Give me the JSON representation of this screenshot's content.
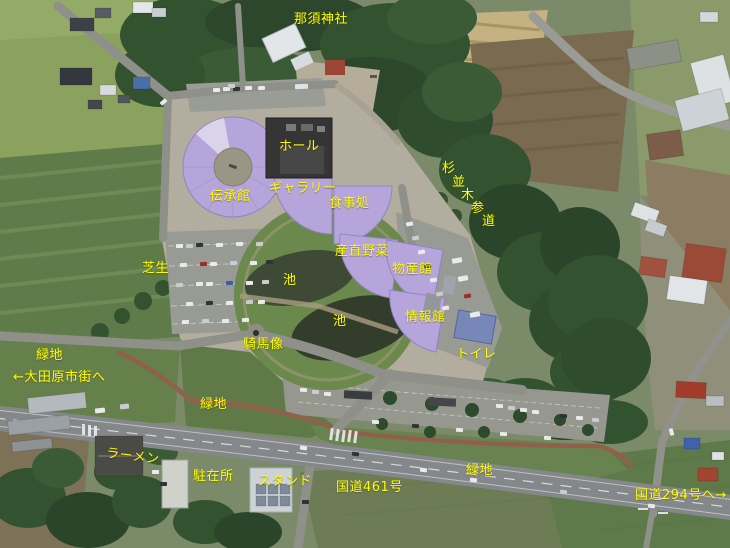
{
  "map": {
    "type": "annotated-aerial-photo",
    "colors": {
      "label_text": "#ffff00",
      "building_highlight": "#b5a5da",
      "toilet_roof": "#7787b8"
    }
  },
  "labels": [
    {
      "name": "nasu-jinja",
      "text": "那須神社",
      "x": 294,
      "y": 13
    },
    {
      "name": "hall",
      "text": "ホール",
      "x": 279,
      "y": 140
    },
    {
      "name": "denshokan",
      "text": "伝承館",
      "x": 210,
      "y": 190
    },
    {
      "name": "gallery",
      "text": "ギャラリー",
      "x": 269,
      "y": 182
    },
    {
      "name": "shokujidokoro",
      "text": "食事処",
      "x": 329,
      "y": 197
    },
    {
      "name": "suginamiki-sando",
      "chars": [
        {
          "c": "杉",
          "x": 442,
          "y": 162
        },
        {
          "c": "並",
          "x": 452,
          "y": 176
        },
        {
          "c": "木",
          "x": 461,
          "y": 189
        },
        {
          "c": "参",
          "x": 471,
          "y": 202
        },
        {
          "c": "道",
          "x": 482,
          "y": 215
        }
      ]
    },
    {
      "name": "shibafu",
      "text": "芝生",
      "x": 142,
      "y": 262
    },
    {
      "name": "sanchoku-yasai",
      "text": "産直野菜",
      "x": 335,
      "y": 245
    },
    {
      "name": "bussankan",
      "text": "物産館",
      "x": 392,
      "y": 263
    },
    {
      "name": "ike-upper",
      "text": "池",
      "x": 283,
      "y": 274
    },
    {
      "name": "ike-lower",
      "text": "池",
      "x": 333,
      "y": 315
    },
    {
      "name": "johokan",
      "text": "情報館",
      "x": 405,
      "y": 311
    },
    {
      "name": "toilet",
      "text": "トイレ",
      "x": 456,
      "y": 348
    },
    {
      "name": "kibazo",
      "text": "騎馬像",
      "x": 243,
      "y": 338
    },
    {
      "name": "ryokuchi-west",
      "text": "緑地",
      "x": 36,
      "y": 349
    },
    {
      "name": "to-otawara",
      "text": "←大田原市街へ",
      "x": 13,
      "y": 371
    },
    {
      "name": "ryokuchi-mid",
      "text": "緑地",
      "x": 200,
      "y": 398
    },
    {
      "name": "ramen",
      "text": "ラーメン",
      "x": 107,
      "y": 447,
      "rotate": 7
    },
    {
      "name": "chuzaisho",
      "text": "駐在所",
      "x": 193,
      "y": 470
    },
    {
      "name": "stand",
      "text": "スタンド",
      "x": 258,
      "y": 475
    },
    {
      "name": "route-461",
      "text": "国道461号",
      "x": 336,
      "y": 481
    },
    {
      "name": "ryokuchi-east",
      "text": "緑地",
      "x": 466,
      "y": 464
    },
    {
      "name": "to-route-294",
      "text": "国道294号へ→",
      "x": 635,
      "y": 489
    }
  ]
}
